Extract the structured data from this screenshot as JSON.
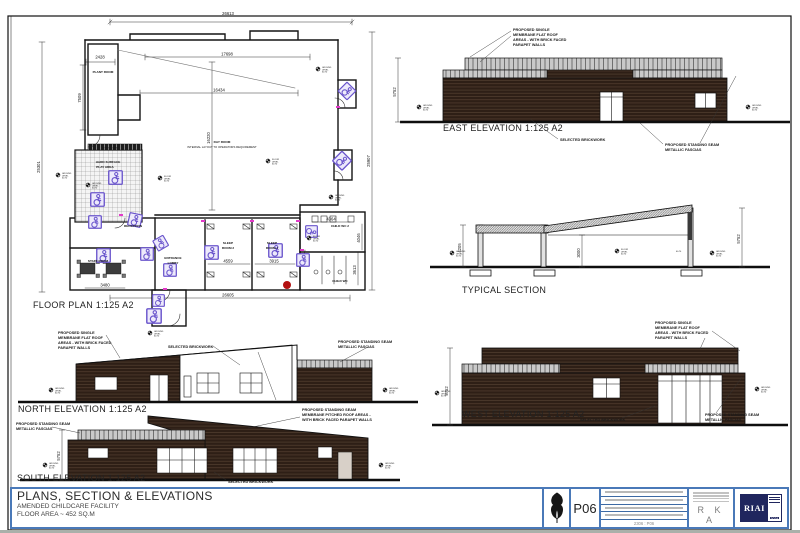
{
  "colors": {
    "brick": "#2e1f16",
    "brick_line": "#6b5440",
    "parapet": "#c9c9c9",
    "line": "#1c1c1c",
    "purple": "#6a55cc",
    "magenta": "#e23ac8",
    "titleblock_border": "#4a79b8",
    "riai_navy": "#20265e",
    "red_dot": "#b31111"
  },
  "markers": {
    "ground": [
      "GROUND",
      "LEVEL",
      "60.70"
    ],
    "floor": [
      "FLOOR",
      "LEVEL",
      "60.70"
    ]
  },
  "notes": {
    "flat_roof": [
      "PROPOSED SINGLE",
      "MEMBRANE FLAT ROOF",
      "AREAS - WITH BRICK FACED",
      "PARAPET WALLS"
    ],
    "brickwork": "SELECTED BRICKWORK",
    "fascia": [
      "PROPOSED STANDING SEAM",
      "METALLIC FASCIAS"
    ],
    "pitched": [
      "PROPOSED STANDING SEAM",
      "MEMBRANE PITCHED ROOF AREAS -",
      "WITH BRICK FACED PARAPET WALLS"
    ]
  },
  "fp": {
    "label": "FLOOR PLAN 1:125 A2",
    "rooms": {
      "plant": "PLANT ROOM",
      "service": "SERVICE YARD",
      "play": [
        "HARD SURFACE",
        "PLAY AREA"
      ],
      "day": [
        "DAY ROOM",
        "INTERNAL LAYOUT TO OPERATORS REQUIREMENT"
      ],
      "reception": "RECEPTION",
      "staff": "STAFF ROOM",
      "lobby": [
        "ENTRANCE",
        "LOBBY"
      ],
      "sleep2": [
        "SLEEP",
        "ROOM 2"
      ],
      "sleep1": [
        "SLEEP",
        "ROOM 1"
      ],
      "childwc2": "CHILD WC 2",
      "childwc": "CHILD WC"
    },
    "dims": {
      "top": "26613",
      "d17698": "17698",
      "d16434": "16434",
      "d16220": "16220",
      "left": "25301",
      "right": "25907",
      "bottom": "26605",
      "plant_w": "2428",
      "plant_h": "7509",
      "sleep2": "4559",
      "sleep1": "3915",
      "wc2_w": "4364",
      "wc2_h": "4046",
      "wc_h": "3613",
      "staff_w": "3480"
    }
  },
  "east": {
    "label": "EAST ELEVATION 1:125 A2",
    "dim": "5752"
  },
  "section": {
    "label": "TYPICAL SECTION",
    "d1": "4205",
    "d2": "3000",
    "d3": "5752",
    "level": "60.70"
  },
  "north": {
    "label": "NORTH ELEVATION 1:125 A2"
  },
  "south": {
    "label": "SOUTH ELEVATION 1:125 A2",
    "dim": "5752"
  },
  "west": {
    "label": "WEST ELEVATION 1:125 A2",
    "dim": "5752"
  },
  "tb": {
    "title": "PLANS, SECTION & ELEVATIONS",
    "subtitle": "AMENDED CHILDCARE FACILITY",
    "area": "FLOOR AREA ~ 452 SQ.M",
    "rev": "P06",
    "revnote": "2306 : P06",
    "firm": "R K A",
    "riai": "RIAI",
    "riai_year": "2024"
  }
}
